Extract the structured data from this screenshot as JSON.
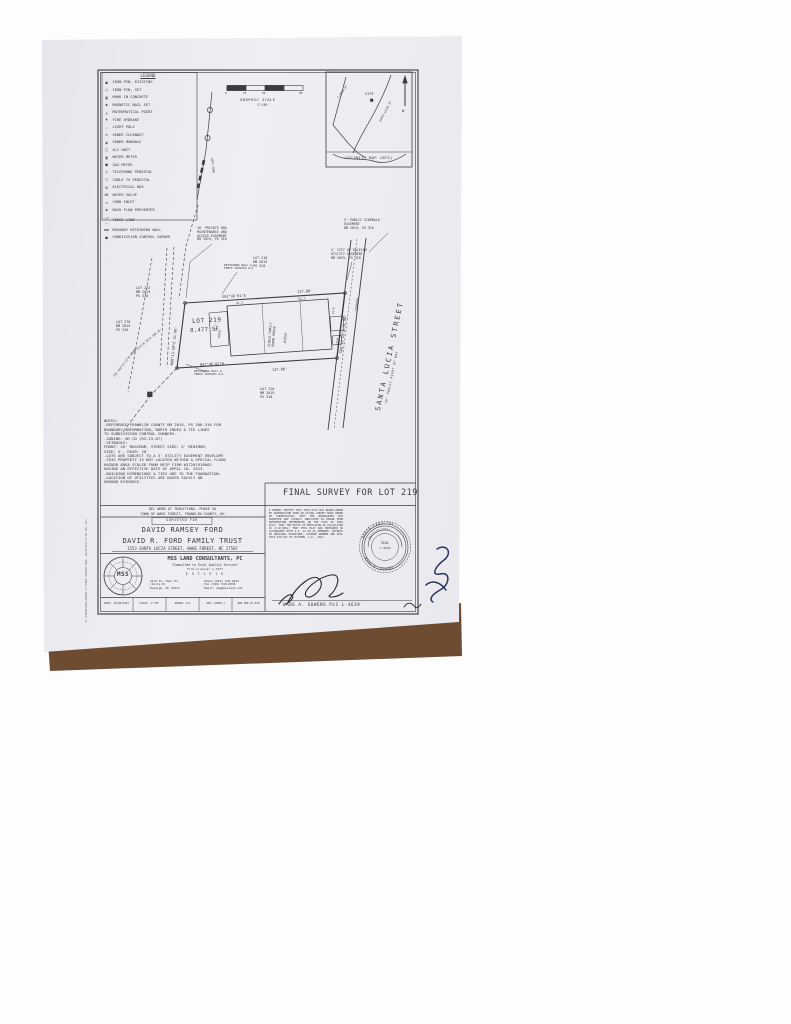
{
  "document": {
    "sheet_title": "FINAL SURVEY FOR LOT 219",
    "side_note": "P:\\10906\\DWG\\10906-1 FINAL SURVEY.DWG, 10/6/2021 9:32 AM, CLG"
  },
  "legend": {
    "title": "LEGEND",
    "items": [
      {
        "symbol": "●",
        "label": "IRON PIN, EXISTING"
      },
      {
        "symbol": "○",
        "label": "IRON PIN, SET"
      },
      {
        "symbol": "▣",
        "label": "MARK IN CONCRETE"
      },
      {
        "symbol": "◆",
        "label": "MAGNETIC NAIL SET"
      },
      {
        "symbol": "△",
        "label": "MATHEMATICAL POINT"
      },
      {
        "symbol": "♦",
        "label": "FIRE HYDRANT"
      },
      {
        "symbol": "☆",
        "label": "LIGHT POLE"
      },
      {
        "symbol": "⊙",
        "label": "SEWER CLEANOUT"
      },
      {
        "symbol": "◉",
        "label": "SEWER MANHOLE"
      },
      {
        "symbol": "□",
        "label": "A/C UNIT"
      },
      {
        "symbol": "▣",
        "label": "WATER METER"
      },
      {
        "symbol": "■",
        "label": "GAS METER"
      },
      {
        "symbol": "⊤",
        "label": "TELEPHONE PEDESTAL"
      },
      {
        "symbol": "▽",
        "label": "CABLE TV PEDESTAL"
      },
      {
        "symbol": "⊠",
        "label": "ELECTRICAL BOX"
      },
      {
        "symbol": "⋈",
        "label": "WATER VALVE"
      },
      {
        "symbol": "◇",
        "label": "YARD INLET"
      },
      {
        "symbol": "◆",
        "label": "BACK FLOW PREVENTER"
      },
      {
        "symbol": "—×—",
        "label": "FENCE LINE"
      },
      {
        "symbol": "▬▬",
        "label": "MASONRY RETAINING WALL"
      },
      {
        "symbol": "■",
        "label": "SUBDIVISION CONTROL CORNER"
      }
    ]
  },
  "scale_bar": {
    "tick0": "0",
    "tick15": "15",
    "tick30": "30",
    "tick60": "60",
    "title": "GRAPHIC SCALE",
    "ratio": "1\"=30'"
  },
  "dirt_road_label": "DIRT ROAD",
  "vicinity": {
    "caption": "VICINITY MAP (NTS)",
    "site": "SITE",
    "north": "N",
    "road_main": "S MAIN ST",
    "road_site": "SANTA LUCIA ST"
  },
  "plat": {
    "lot_name": "LOT 219",
    "lot_area": "8,477 SF",
    "bearing_top": "S81°46'01\"E",
    "dist_top": "127.00'",
    "bearing_bottom": "N81°46'01\"W",
    "dist_bottom": "127.00'",
    "bearing_right": "S08°13'59\"W 51.00'",
    "bearing_left": "N08°13'59\"E 51.00'",
    "street_name": "SANTA LUCIA STREET",
    "street_rw": "50' PUBLIC RIGHT OF WAY",
    "sidewalk_label": "SIDEWALK",
    "house_label": "SINGLE FAMILY\nFRAME HOUSE",
    "house_number": "#1553",
    "porch_label": "PORCH",
    "stoop_label": "STOOP",
    "dim_a": "41.7'",
    "dim_b": "56.2'",
    "dim_c": "12.1'",
    "dim_d": "24.8'",
    "lot_218": "LOT 218\nBM 2019\nPG 310",
    "lot_273": "LOT 273\nBM 2019\nPG 310",
    "lot_270": "LOT 270\nBM 2019\nPG 310",
    "lot_220": "LOT 220\nBM 2019\nPG 310",
    "easement_hoa": "10' PRIVATE HOA\nMAINTENANCE AND\nACCESS EASEMENT\nBM 2019, PG 310",
    "easement_sidewalk": "5' PUBLIC SIDEWALK\nEASEMENT\nBM 2019, PG 310",
    "easement_utility": "5' CITY OF RALEIGH\nUTILITY EASEMENT\nBM 2019, PG 310",
    "wall_note_top": "RETAINING WALL &\nFENCE CROSSES P/L",
    "wall_note_bottom": "RETAINING WALL &\nFENCE CROSSES P/L",
    "tie_1": "TIE S13°25'20\"W 190.45'",
    "tie_2": "TIE S44°53'35\"W 48.59'"
  },
  "notes": "NOTES:\n-REFERENCE FRANKLIN COUNTY BM 2019, PG 308-310 FOR\n BOUNDARY INFORMATION, NORTH INDEX & TIE LINES\n TO SUBDIVISION CONTROL CORNERS.\n-ZONING: UR CD (RZ-15-07)\n-SETBACKS:\n   FRONT: 20' MAXIMUM, STREET SIDE: 5' MINIMUM,\n   SIDE: 5', REAR: 20'\n-LOTS ARE SUBJECT TO A 5' UTILITY EASEMENT ENVELOPE\n-THIS PROPERTY IS NOT LOCATED WITHIN A SPECIAL FLOOD\n HAZARD AREA SCALED FROM NFIP FIRM #3720191800J\n HAVING AN EFFECTIVE DATE OF APRIL 16, 2013.\n-BUILDING DIMENSIONS & TIES ARE TO THE FOUNDATION.\n-LOCATION OF UTILITIES ARE BASED SOLELY ON\n GROUND EVIDENCE.",
  "title_block": {
    "project": "DEL WEBB AT TRADITIONS, PHASE 5A",
    "jurisdiction": "TOWN OF WAKE FOREST, FRANKLIN COUNTY, NC",
    "surveyed_for": "SURVEYED FOR",
    "client_1": "DAVID RAMSEY FORD",
    "client_2": "DAVID R. FORD FAMILY TRUST",
    "address": "1553 SANTA LUCIA STREET, WAKE FOREST, NC 27587",
    "firm": {
      "logo": "MSS",
      "name": "MSS LAND CONSULTANTS, PC",
      "tagline": "\"Committed to Total Quality Service\"",
      "license": "Firm License: C-3277",
      "est": "E S T   1 9 1 9",
      "addr": "4113 St. Omer Pl.\n(Suite B)\nRaleigh, NC 27612",
      "contact": "Phone (919) 510-4444\nFax (919) 510-8038\nEmail: wag@mssland.com"
    },
    "strip": [
      "SURV: 10/06/2021",
      "SCALE: 1\"=30'",
      "DRAWN: CLG",
      "JOB: 10906.1",
      "PER PRE-16-078"
    ],
    "certification": "I HEREBY CERTIFY THAT THIS PLAT WAS DRAWN UNDER MY SUPERVISION FROM AN ACTUAL SURVEY MADE UNDER MY SUPERVISION; THAT THE BOUNDARIES NOT SURVEYED ARE CLEARLY INDICATED AS DRAWN FROM INFORMATION REFERENCED ON THE FACE OF THIS PLAT; THAT THE RATIO OF PRECISION AS CALCULATED IS 1:10,000+; THAT THIS PLAT WAS PREPARED IN ACCORDANCE WITH G.S. 47-30 AS AMENDED. WITNESS MY ORIGINAL SIGNATURE, LICENSE NUMBER AND SEAL THIS 6TH DAY OF OCTOBER, A.D., 2021.",
    "surveyor_line": "WADE A. GOWENS PLS L-4639",
    "seal": {
      "top": "NORTH CAROLINA",
      "mid": "PROFESSIONAL",
      "center1": "SEAL",
      "center2": "L-4639",
      "bottom": "WADE A. GOWENS"
    }
  },
  "colors": {
    "ink": "#3b3b43",
    "paper": "#e9e8ed",
    "rug_brown": "#6d4c31",
    "rug_black": "#16110d",
    "pen": "#2a3560"
  }
}
